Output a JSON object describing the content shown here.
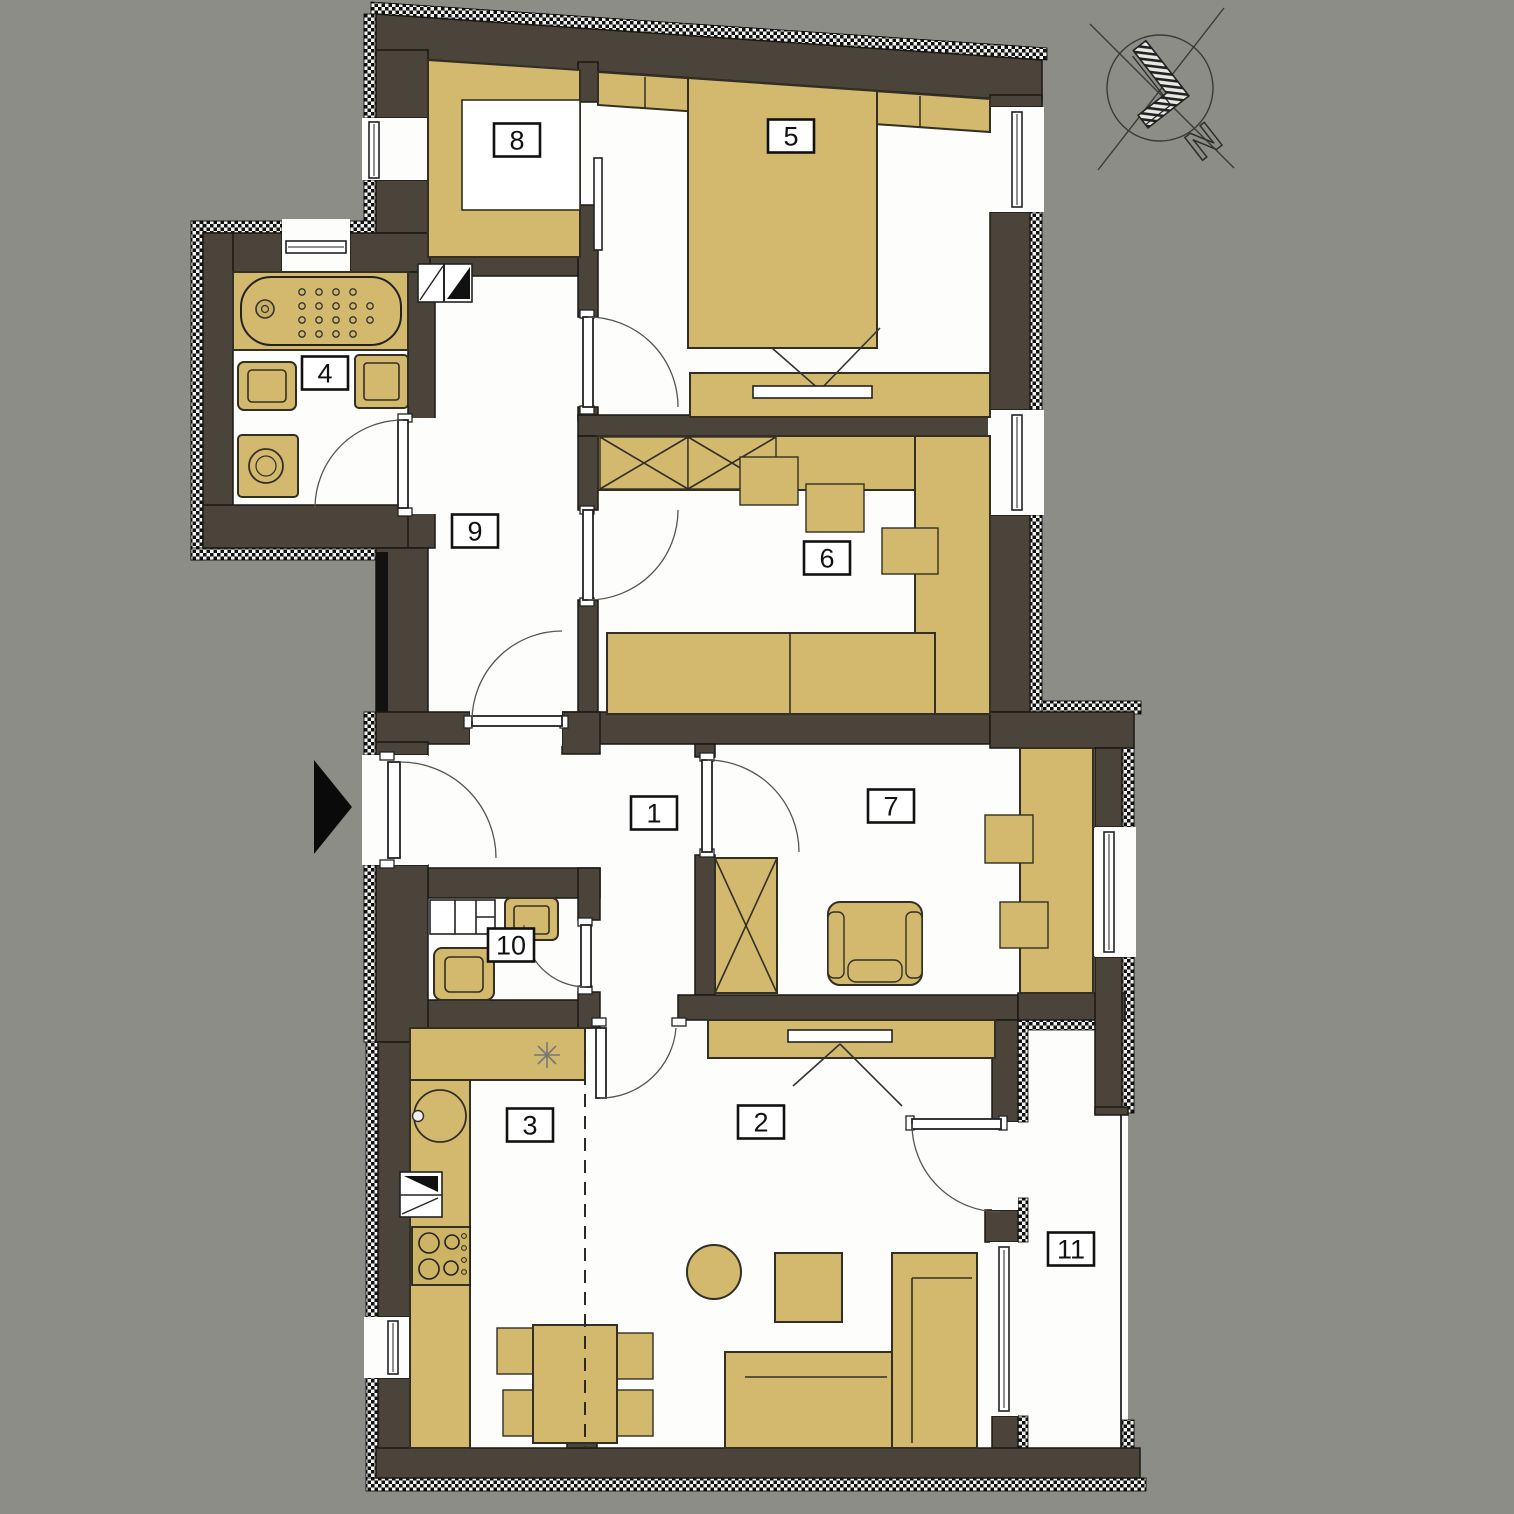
{
  "title": "apartment-floor-plan",
  "colors": {
    "background": "#8d8d88",
    "wall": "#4a443a",
    "furniture": "#d2b96e",
    "floor": "#fdfdfc",
    "line": "#1a1813"
  },
  "compass": {
    "north_label": "N"
  },
  "rooms": [
    {
      "label": "1"
    },
    {
      "label": "2"
    },
    {
      "label": "3"
    },
    {
      "label": "4"
    },
    {
      "label": "5"
    },
    {
      "label": "6"
    },
    {
      "label": "7"
    },
    {
      "label": "8"
    },
    {
      "label": "9"
    },
    {
      "label": "10"
    },
    {
      "label": "11"
    }
  ]
}
